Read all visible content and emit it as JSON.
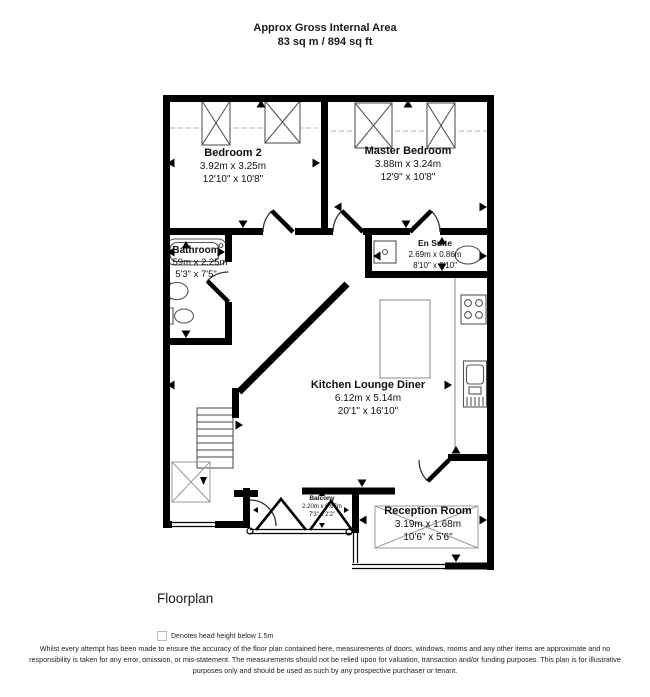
{
  "header": {
    "line1": "Approx Gross Internal Area",
    "line2": "83 sq m / 894 sq ft"
  },
  "rooms": [
    {
      "name": "Bedroom 2",
      "metric": "3.92m x 3.25m",
      "imperial": "12'10\" x 10'8\""
    },
    {
      "name": "Master Bedroom",
      "metric": "3.88m x 3.24m",
      "imperial": "12'9\" x 10'8\""
    },
    {
      "name": "Bathroom",
      "metric": "1.59m x 2.25m",
      "imperial": "5'3\" x 7'5\""
    },
    {
      "name": "En Suite",
      "metric": "2.69m x 0.86m",
      "imperial": "8'10\" x 2'10\""
    },
    {
      "name": "Kitchen Lounge Diner",
      "metric": "6.12m x 5.14m",
      "imperial": "20'1\" x 16'10\""
    },
    {
      "name": "Reception Room",
      "metric": "3.19m x 1.68m",
      "imperial": "10'6\" x 5'6\""
    },
    {
      "name": "Balcony",
      "metric": "2.20m x 0.67m",
      "imperial": "7'3\" x 2'2\""
    }
  ],
  "footer": {
    "plan_label": "Floorplan",
    "legend_icon": "crossed-box-icon",
    "legend": "Denotes head height below 1.5m",
    "disclaimer": "Whilst every attempt has been made to ensure the accuracy of the floor plan contained here, measurements of doors, windows, rooms and any other items are approximate and no responsibility is taken for any error, omission, or mis-statement. The measurements should not be relied upon for valuation, transaction and/or funding purposes. This plan is for illustrative purposes only and should be used as such by any prospective purchaser or tenant."
  },
  "colors": {
    "wall": "#000000",
    "fixture": "#555555",
    "head_height_box": "#999999"
  }
}
